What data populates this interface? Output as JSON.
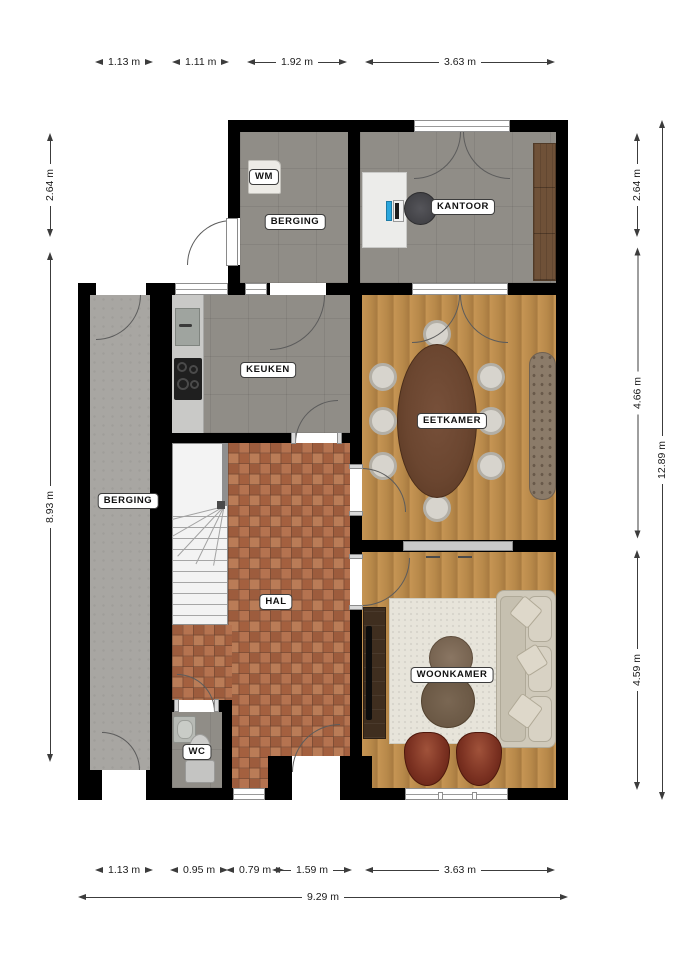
{
  "rooms": {
    "berging_top": {
      "label": "BERGING"
    },
    "kantoor": {
      "label": "KANTOOR"
    },
    "keuken": {
      "label": "KEUKEN"
    },
    "berging_left": {
      "label": "BERGING"
    },
    "hal": {
      "label": "HAL"
    },
    "eetkamer": {
      "label": "EETKAMER"
    },
    "woonkamer": {
      "label": "WOONKAMER"
    },
    "wc": {
      "label": "WC"
    },
    "wm": {
      "label": "WM"
    }
  },
  "dimensions": {
    "top": [
      {
        "label": "1.13 m"
      },
      {
        "label": "1.11 m"
      },
      {
        "label": "1.92 m"
      },
      {
        "label": "3.63 m"
      }
    ],
    "bottom": [
      {
        "label": "1.13 m"
      },
      {
        "label": "0.95 m"
      },
      {
        "label": "0.79 m"
      },
      {
        "label": "1.59 m"
      },
      {
        "label": "3.63 m"
      }
    ],
    "bottom_total": {
      "label": "9.29 m"
    },
    "left": [
      {
        "label": "2.64 m"
      },
      {
        "label": "8.93 m"
      }
    ],
    "right": [
      {
        "label": "2.64 m"
      },
      {
        "label": "4.66 m"
      },
      {
        "label": "4.59 m"
      }
    ],
    "right_total": {
      "label": "12.89 m"
    }
  },
  "colors": {
    "wall": "#000000",
    "wood_floor": "#bb8c49",
    "gray_tile": "#908d87",
    "concrete": "#a8a6a2",
    "hal_tile": "#b3704c",
    "sofa": "#cfc9ba",
    "armchair": "#7c3222",
    "dining_table": "#6b4630",
    "closet_wood": "#6f5138"
  }
}
